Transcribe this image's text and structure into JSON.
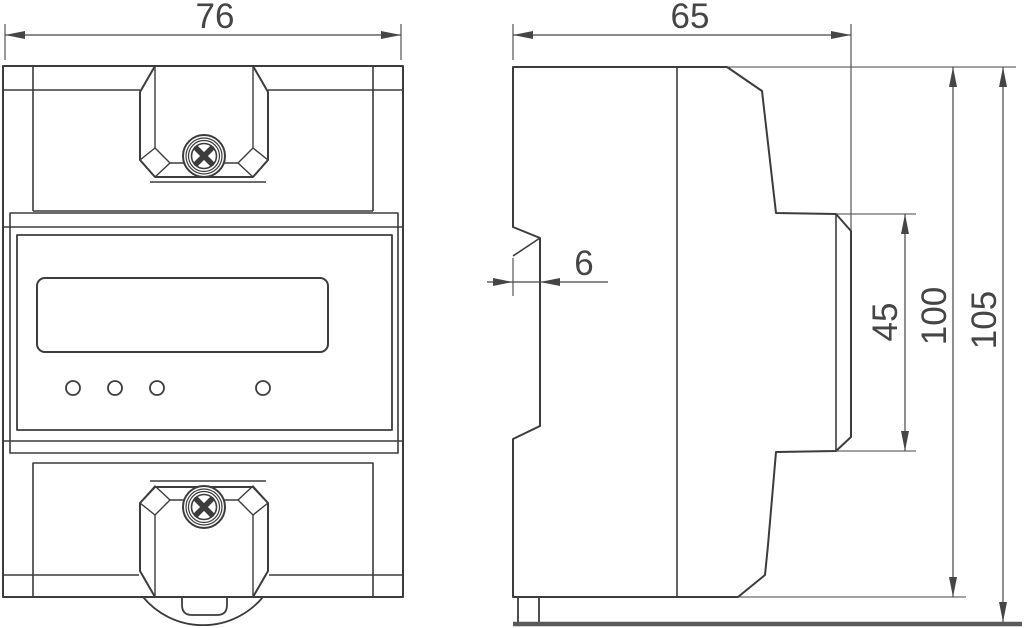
{
  "drawing": {
    "background": "#ffffff",
    "line_color": "#3c3c3c",
    "dimension_color": "#454545",
    "baseline_color": "#5a5a5a",
    "dimensions": {
      "front_width": "76",
      "side_depth": "65",
      "panel_protrusion": "6",
      "rail_recess_height": "45",
      "body_height": "100",
      "overall_height": "105"
    }
  }
}
